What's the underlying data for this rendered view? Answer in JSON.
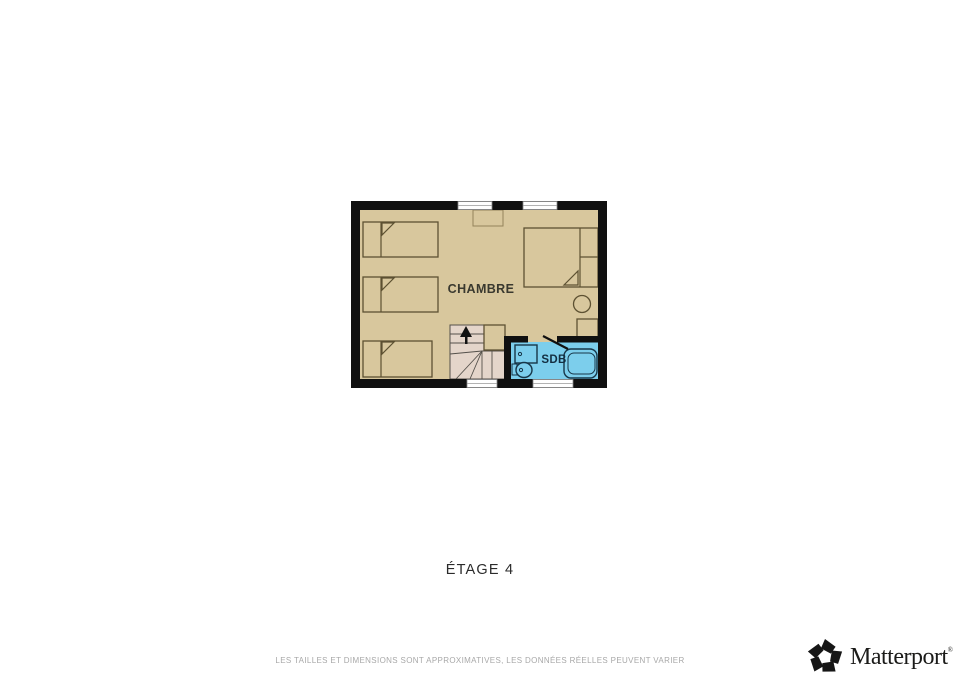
{
  "floorplan": {
    "level_label": "ÉTAGE 4",
    "room_labels": {
      "bedroom": "CHAMBRE",
      "bathroom": "SDB"
    },
    "colors": {
      "wall": "#101010",
      "bedroom_floor": "#D8C79D",
      "stairs_floor": "#E4D5CA",
      "bathroom_floor": "#7CCEEC",
      "furniture_outline": "#5d5132",
      "bathroom_outline": "#173648",
      "stair_line": "#54504a"
    }
  },
  "footer": {
    "disclaimer": "LES TAILLES ET DIMENSIONS SONT APPROXIMATIVES, LES DONNÉES RÉELLES PEUVENT VARIER"
  },
  "branding": {
    "name": "Matterport",
    "trademark": "®"
  }
}
